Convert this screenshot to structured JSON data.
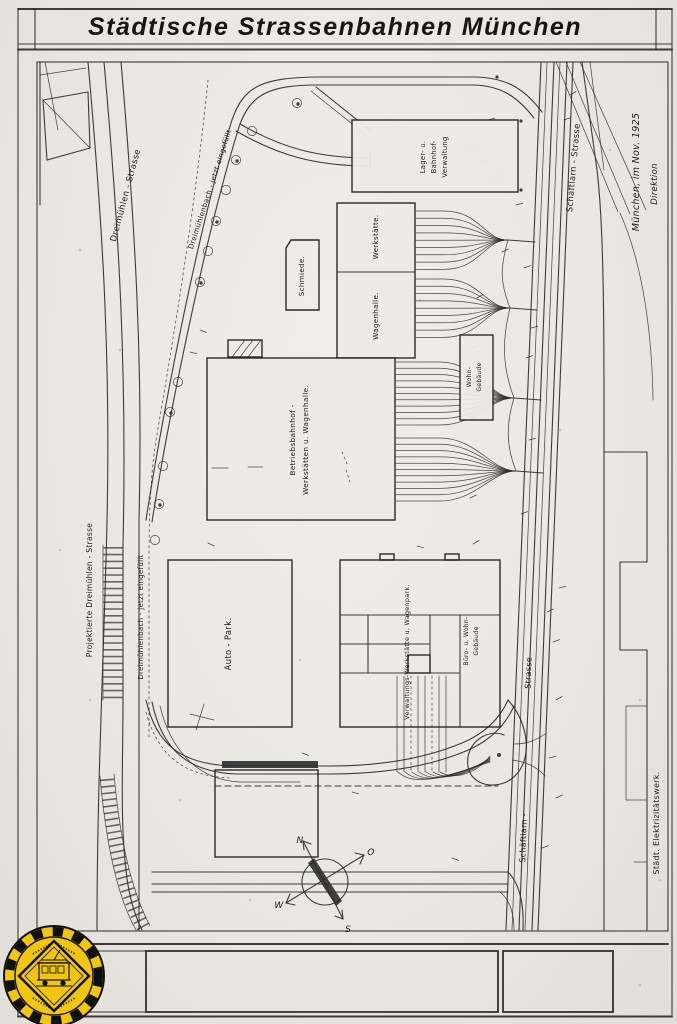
{
  "title": "Städtische Strassenbahnen München",
  "imprint": {
    "place_date": "München, im Nov. 1925",
    "authority": "Direktion"
  },
  "streets": {
    "dreimuehlen": "Dreimühlen  -  Strasse",
    "projektierte_dreimuehlen": "Projektierte Dreimühlen - Strasse",
    "bach_top": "Dreimühlenbach - jetzt eingefüllt",
    "bach_left": "Dreimühlenbach  -  jetzt eingefüllt",
    "schaeftlarn_top": "Schäftlarn - Strasse",
    "schaeftlarn_bottom_name": "Schäftlarn -",
    "schaeftlarn_bottom_str": "Strasse"
  },
  "buildings": {
    "verwaltung": {
      "l1": "Lager- u.",
      "l2": "Bahnhof-",
      "l3": "Verwaltung"
    },
    "schmiede": "Schmiede.",
    "werkstaette": "Werkstätte.",
    "wagenhalle": "Wagenhalle.",
    "wohngebaeude": {
      "l1": "Wohn-",
      "l2": "Gebäude"
    },
    "betriebsbahnhof": {
      "l1": "Betriebsbahnhof -",
      "l2": "Werkstätten u. Wagenhalle."
    },
    "autopark": "Auto - Park.",
    "werkstatt_wagenpark": "Verwaltungs-Werkstätte u. Wagenpark.",
    "buero": {
      "l1": "Büro- u. Wohn-",
      "l2": "Gebäude"
    }
  },
  "neighbors": {
    "elektrizitaetswerk": "Städt. Elektrizitätswerk."
  },
  "compass": {
    "n": "N",
    "o": "O",
    "s": "S",
    "w": "W"
  },
  "badge": {
    "icon": "tram-museum-badge"
  },
  "colors": {
    "paper": "#eae8e2",
    "ink": "#2e2d2b",
    "badge_yellow": "#f0c513"
  }
}
